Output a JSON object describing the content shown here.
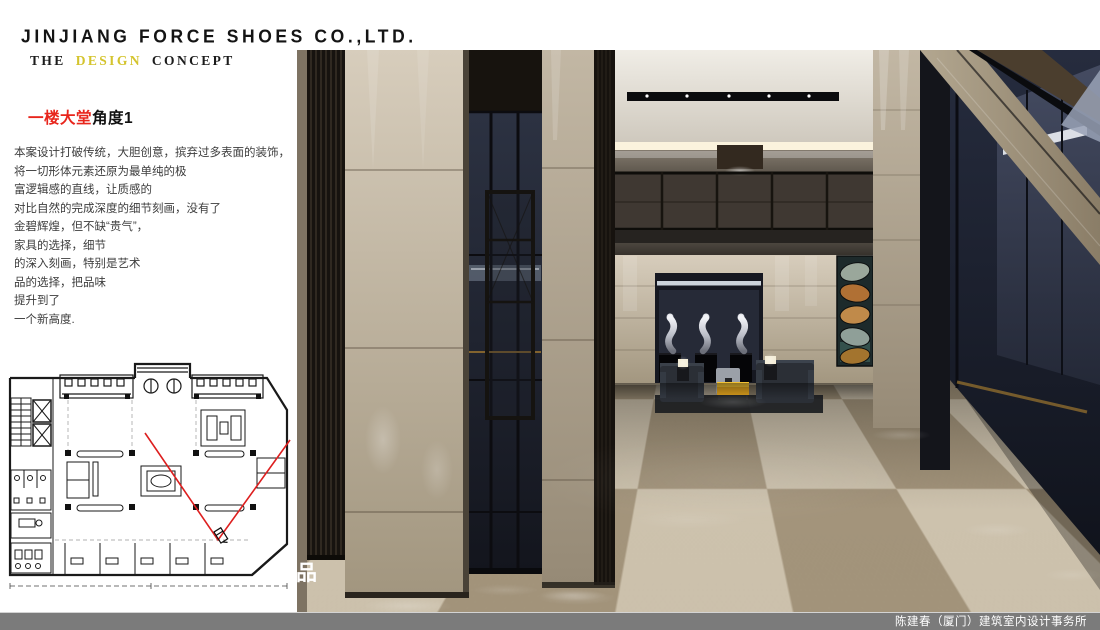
{
  "header": {
    "company": "JINJIANG FORCE SHOES CO.,LTD.",
    "subtitle": {
      "pre": "THE",
      "accent": "DESIGN",
      "post": "CONCEPT"
    }
  },
  "view": {
    "heading_red": "一楼大堂",
    "heading_suffix": "角度1"
  },
  "description": {
    "lines": [
      "本案设计打破传统，大胆创意，摈弃过多表面的装饰，",
      "将一切形体元素还原为最单纯的极",
      "富逻辑感的直线，让质感的",
      "对比自然的完成深度的细节刻画，没有了",
      "金碧辉煌，但不缺“贵气”，",
      "家具的选择，细节",
      "的深入刻画，特别是艺术",
      "品的选择，把品味",
      "提升到了",
      "一个新高度."
    ]
  },
  "watermark": {
    "char": "品"
  },
  "footer": {
    "credit": "陈建春（厦门）建筑室内设计事务所"
  },
  "colors": {
    "accent_yellow": "#d4c42e",
    "heading_red": "#e8251c",
    "plan_red": "#dd1f1f",
    "footer_bar": "#7b7b7b",
    "floor_tile_light": "#cdc2ad",
    "floor_tile_dark": "#a3947b",
    "coffee_table_yellow": "#f2c133"
  }
}
